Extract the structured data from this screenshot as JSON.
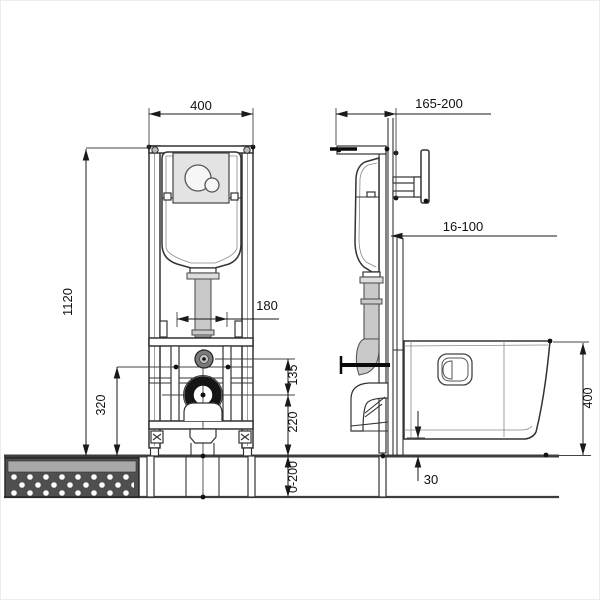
{
  "dimensions": {
    "front": {
      "frame_width": "400",
      "frame_height": "1120",
      "fixing_spacing": "180",
      "inlet_height": "320",
      "inlet_to_outlet": "135",
      "outlet_height": "220",
      "floor_buildup_range": "0-200"
    },
    "side": {
      "frame_depth_range": "165-200",
      "facing_thickness_range": "16-100",
      "bowl_height": "400",
      "bowl_floor_gap": "30"
    }
  }
}
